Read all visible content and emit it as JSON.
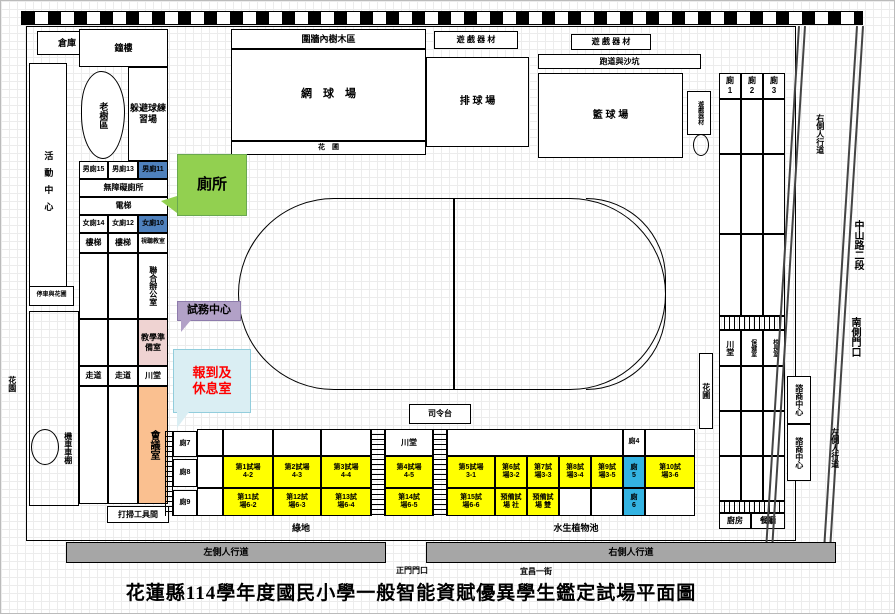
{
  "title": "花蓮縣114學年度國民小學一般智能資賦優異學生鑑定試場平面圖",
  "colors": {
    "exam_room_yellow": "#FFFF00",
    "toilet_highlight_blue": "#4F81BD",
    "toilet_cyan_blue": "#33B3E2",
    "callout_green": "#92D050",
    "callout_purple": "#B2A1C7",
    "callout_lightblue": "#DAEEF3",
    "checkin_text_red": "#FF0000",
    "meeting_room_orange": "#FAC090",
    "prep_room_pink": "#EFD3D2",
    "sidewalk_gray": "#A6A6A6"
  },
  "top": {
    "warehouse": "倉庫",
    "bell_building": "鐘樓",
    "walled_tree_area": "圍牆內樹木區",
    "tennis_court": "網　球　場",
    "flower_bed": "花　圃",
    "play_equipment_a": "遊 戲 器 材",
    "volleyball_court": "排 球 場",
    "play_equipment_b": "遊 戲 器 材",
    "track_and_sandpit": "跑道與沙坑",
    "basketball_court": "籃 球 場",
    "play_equipment_c": "遊戲器材",
    "toilet1": "廁\n1",
    "toilet2": "廁\n2",
    "toilet3": "廁\n3"
  },
  "left": {
    "activity_center": "活動中心",
    "old_tree_area": "老樹區",
    "dodgeball_practice": "躲避球練習場",
    "mens15": "男廁15",
    "mens13": "男廁13",
    "mens11": "男廁11",
    "accessible_toilet": "無障礙廁所",
    "elevator": "電梯",
    "womens14": "女廁14",
    "womens12": "女廁12",
    "womens10": "女廁10",
    "stairs": "樓梯",
    "av_room": "視聽教室",
    "joint_office": "聯合辦公室",
    "teaching_prep": "教學準備室",
    "corridor": "走道",
    "hall": "川堂",
    "meeting_room": "會議室",
    "parking_flower": "停車與花圃",
    "garden": "花園",
    "scooter_shed": "機車車棚",
    "cleaning_tools": "打掃工具間"
  },
  "center": {
    "stage": "司令台",
    "green_space": "綠地",
    "aquatic_pond": "水生植物池"
  },
  "right": {
    "hall": "川堂",
    "health_room": "保健室",
    "principal_room": "校長室",
    "flower_bed": "花圃",
    "counseling_center": "諮商中心",
    "kitchen": "廚房",
    "dining_hall": "餐廳",
    "sidewalk_top": "右側人行道",
    "zhongshan_rd": "中山路二段",
    "south_gate": "南側門口",
    "sidewalk_road": "左側人行道"
  },
  "callouts": {
    "toilet": "廁所",
    "exam_office": "試務中心",
    "checkin_rest": "報到及\n休息室"
  },
  "exam_grid": {
    "hall": "川堂",
    "toilet4": "廁4",
    "toilet5": "廁\n5",
    "toilet6": "廁\n6",
    "toilet7": "廁7",
    "toilet8": "廁8",
    "toilet9": "廁9",
    "row1": [
      "第1試場\n4-2",
      "第2試場\n4-3",
      "第3試場\n4-4",
      "第4試場\n4-5",
      "第5試場\n3-1",
      "第6試\n場3-2",
      "第7試\n場3-3",
      "第8試\n場3-4",
      "第9試\n場3-5",
      "第10試\n場3-6"
    ],
    "row2": [
      "第11試\n場6-2",
      "第12試\n場6-3",
      "第13試\n場6-4",
      "第14試\n場6-5",
      "第15試\n場6-6",
      "預備試\n場 社",
      "預備試\n場 雙"
    ]
  },
  "bottom": {
    "left_sidewalk": "左側人行道",
    "right_sidewalk": "右側人行道",
    "main_gate": "正門門口",
    "street": "宜昌一街"
  }
}
